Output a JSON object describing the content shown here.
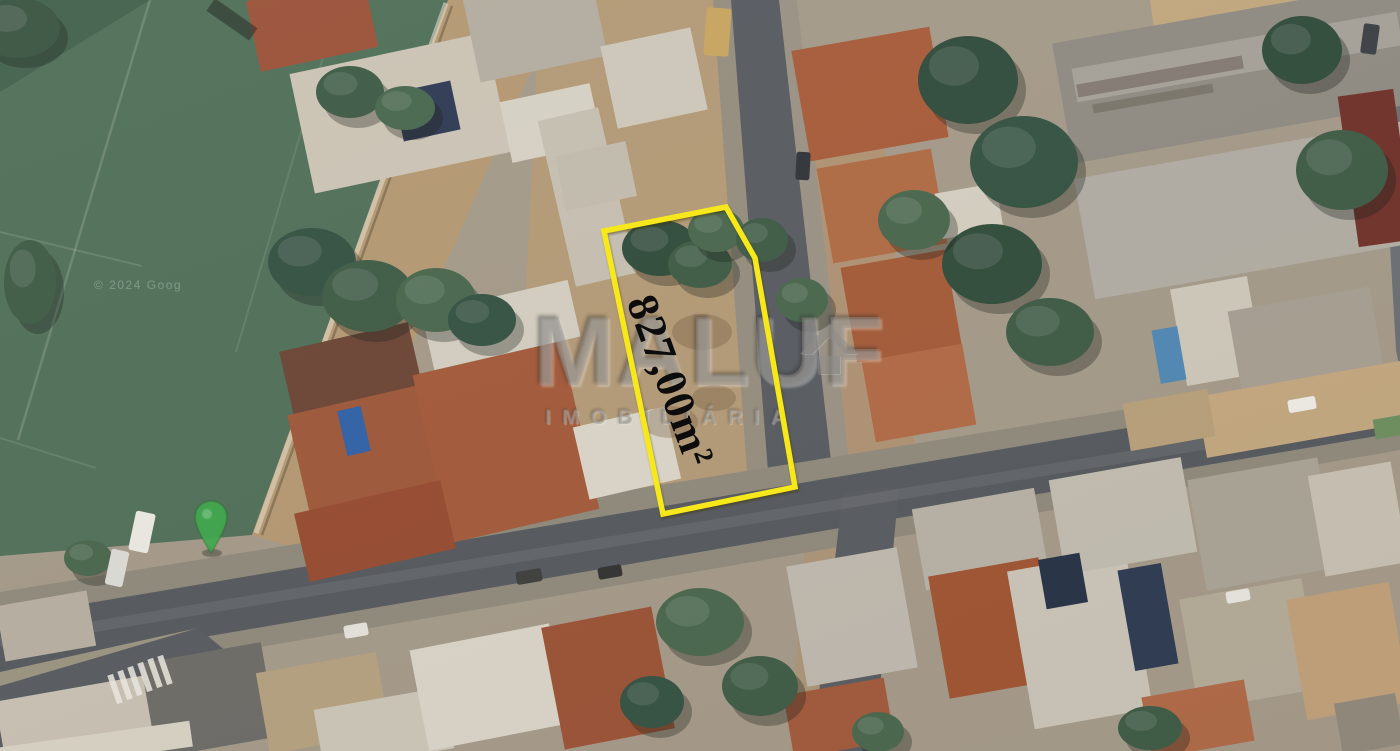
{
  "map": {
    "attribution": "© 2024 Goog",
    "marker_color": "#42a94f"
  },
  "lot": {
    "area_label": "827,00m²",
    "outline_color": "#f7e81b",
    "polygon": "604,231 726,207 755,258 795,487 663,514"
  },
  "watermark": {
    "title": "MALUF",
    "subtitle": "IMOBILIÁRIA"
  },
  "palette": {
    "field_green": "#4e6e57",
    "road_gray": "#53575d",
    "dirt_tan": "#b59872",
    "terracotta": "#a85a38",
    "tree_green": "#315040",
    "outline_yellow": "#f7e81b",
    "pin_green": "#42a94f"
  },
  "scene": {
    "ground": [
      {
        "pts": "0,0 1400,0 1400,751 0,751",
        "f": "#a59a89",
        "name": "ground-base"
      },
      {
        "pts": "0,0 448,0 392,148 252,535 0,556",
        "f": "#4e6e57",
        "name": "soccer-field"
      },
      {
        "pts": "0,0 150,0 0,92",
        "f": "#41604b",
        "name": "field-corner-shade"
      },
      {
        "pts": "448,0 562,0 430,300 330,558 252,535 392,148",
        "f": "#b59872",
        "name": "dirt-strip"
      },
      {
        "pts": "540,0 733,0 770,485 640,520 520,420",
        "f": "#b49a76",
        "name": "dirt-lot-area"
      },
      {
        "pts": "800,150 884,142 918,478 836,480",
        "f": "#b09273",
        "name": "dirt-patch"
      },
      {
        "pts": "1150,0 1382,0 1374,46 1158,56",
        "f": "#c3a87e",
        "name": "dirt-top-right"
      },
      {
        "pts": "806,520 850,516 872,751 790,751",
        "f": "#ac9578",
        "name": "dirt-south-strip"
      }
    ],
    "roads": [
      {
        "pts": "713,0 731,0 769,484 748,486",
        "f": "#958d7e",
        "name": "sidewalk"
      },
      {
        "pts": "779,0 797,0 851,477 833,479",
        "f": "#9a9284",
        "name": "sidewalk"
      },
      {
        "pts": "731,0 779,0 833,479 769,484",
        "f": "#565a60",
        "name": "street-vertical"
      },
      {
        "pts": "0,592 1400,365 1400,382 0,618",
        "f": "#8f897b",
        "name": "sidewalk"
      },
      {
        "pts": "0,672 1400,432 1400,450 0,692",
        "f": "#8f897b",
        "name": "sidewalk"
      },
      {
        "pts": "0,618 1400,382 1400,432 0,672",
        "f": "#53575d",
        "name": "main-road"
      },
      {
        "pts": "843,492 899,487 874,751 812,751",
        "f": "#565a60",
        "name": "street-vertical-south"
      },
      {
        "pts": "0,672 198,628 0,686",
        "f": "#99937f",
        "name": "sidewalk"
      },
      {
        "pts": "0,686 0,748 232,656 198,628",
        "f": "#55595f",
        "name": "street-branch"
      },
      {
        "pts": "1376,0 1400,0 1400,370 1396,350",
        "f": "#6a6e72",
        "name": "street-edge-east"
      }
    ],
    "lines": [
      {
        "d": "M150,0 L18,440",
        "s": "rgba(255,255,255,0.16)",
        "w": 2.5,
        "name": "field-line"
      },
      {
        "d": "M340,0 L236,352",
        "s": "rgba(255,255,255,0.10)",
        "w": 2,
        "name": "field-line"
      },
      {
        "d": "M0,232 L142,266",
        "s": "rgba(255,255,255,0.13)",
        "w": 2,
        "name": "field-line"
      },
      {
        "d": "M0,438 L96,468",
        "s": "rgba(255,255,255,0.11)",
        "w": 2,
        "name": "field-line"
      },
      {
        "d": "M446,3 L256,533",
        "s": "rgba(235,228,210,0.55)",
        "w": 5,
        "name": "field-wall"
      },
      {
        "d": "M452,6 L262,535",
        "s": "rgba(70,60,40,0.40)",
        "w": 2.5,
        "name": "field-wall-shadow"
      },
      {
        "d": "M0,642 L1400,412",
        "s": "rgba(210,210,205,0.10)",
        "w": 11,
        "name": "road-wear"
      }
    ],
    "buildings": [
      [
        252,
        -12,
        120,
        72,
        -12,
        "#9b5138"
      ],
      [
        300,
        52,
        200,
        122,
        -12,
        "#cdc5b6"
      ],
      [
        398,
        86,
        58,
        50,
        -12,
        "#2d3752"
      ],
      [
        470,
        -18,
        130,
        88,
        -12,
        "#b4ada0"
      ],
      [
        505,
        92,
        92,
        62,
        -12,
        "#d8d2c6"
      ],
      [
        556,
        112,
        62,
        170,
        -13,
        "#c7c0b2"
      ],
      [
        286,
        336,
        132,
        76,
        -13,
        "#6b4334"
      ],
      [
        298,
        398,
        142,
        112,
        -13,
        "#9e5637"
      ],
      [
        430,
        356,
        152,
        172,
        -13,
        "#a35838"
      ],
      [
        426,
        296,
        150,
        58,
        -13,
        "#d5cfc2"
      ],
      [
        580,
        416,
        94,
        74,
        -13,
        "#dcd7ca"
      ],
      [
        300,
        496,
        150,
        70,
        -13,
        "#96492e"
      ],
      [
        608,
        36,
        92,
        84,
        -12,
        "#cfc9bc"
      ],
      [
        560,
        148,
        72,
        56,
        -12,
        "#c3bcae"
      ],
      [
        800,
        38,
        140,
        112,
        -10,
        "#a85a38"
      ],
      [
        824,
        158,
        116,
        96,
        -10,
        "#b06a42"
      ],
      [
        848,
        258,
        106,
        96,
        -10,
        "#a55936"
      ],
      [
        868,
        352,
        102,
        82,
        -10,
        "#b26844"
      ],
      [
        938,
        188,
        62,
        46,
        -10,
        "#d6d0c3"
      ],
      [
        1060,
        12,
        352,
        122,
        -10,
        "#8f8a82",
        "warehouse-roof"
      ],
      [
        1072,
        40,
        330,
        34,
        -10,
        "#a6a199",
        "warehouse-roof-band"
      ],
      [
        1082,
        148,
        348,
        122,
        -10,
        "#b2ada4",
        "warehouse-roof"
      ],
      [
        1178,
        282,
        78,
        98,
        -10,
        "#cfc9bc"
      ],
      [
        1348,
        92,
        56,
        152,
        -8,
        "#6f2f28"
      ],
      [
        1238,
        298,
        144,
        132,
        -10,
        "#a79f92"
      ],
      [
        1200,
        378,
        212,
        62,
        -10,
        "#c4a87f"
      ],
      [
        1126,
        396,
        86,
        48,
        -10,
        "#b8a07a"
      ],
      [
        0,
        598,
        92,
        56,
        -10,
        "#b7b0a2"
      ],
      [
        0,
        688,
        152,
        70,
        -10,
        "#c9c2b4"
      ],
      [
        148,
        652,
        122,
        96,
        -10,
        "#6b6a66"
      ],
      [
        262,
        662,
        122,
        82,
        -10,
        "#b4a17f"
      ],
      [
        318,
        698,
        132,
        62,
        -10,
        "#cdc7b9"
      ],
      [
        0,
        734,
        192,
        26,
        -8,
        "#d9d3c5"
      ],
      [
        418,
        636,
        142,
        102,
        -11,
        "#dbd6c9"
      ],
      [
        552,
        616,
        112,
        124,
        -11,
        "#9b5134"
      ],
      [
        796,
        556,
        112,
        122,
        -10,
        "#c0bab0"
      ],
      [
        788,
        686,
        102,
        64,
        -10,
        "#a2583a"
      ],
      [
        918,
        498,
        124,
        82,
        -10,
        "#b9b3a7"
      ],
      [
        938,
        566,
        112,
        124,
        -10,
        "#a0522f"
      ],
      [
        1020,
        560,
        120,
        160,
        -10,
        "#ccc6ba"
      ],
      [
        1056,
        468,
        134,
        96,
        -10,
        "#c3beb2"
      ],
      [
        1196,
        468,
        132,
        112,
        -10,
        "#aaa496"
      ],
      [
        1188,
        588,
        124,
        112,
        -10,
        "#b5ab99"
      ],
      [
        1316,
        468,
        84,
        102,
        -10,
        "#c9c2b4"
      ],
      [
        1296,
        590,
        104,
        122,
        -10,
        "#c2a179"
      ],
      [
        1146,
        688,
        104,
        62,
        -10,
        "#b06845"
      ],
      [
        1338,
        698,
        62,
        52,
        -10,
        "#90897c"
      ]
    ],
    "extras": [
      {
        "t": "rect",
        "x": 342,
        "y": 408,
        "w": 24,
        "h": 46,
        "r": -13,
        "f": "#2d5fa8",
        "name": "swimming-pool"
      },
      {
        "t": "rect",
        "x": 1156,
        "y": 328,
        "w": 26,
        "h": 54,
        "r": -10,
        "f": "#4d87b5",
        "name": "swimming-pool"
      },
      {
        "t": "rect",
        "x": 1042,
        "y": 556,
        "w": 42,
        "h": 50,
        "r": -10,
        "f": "#233044",
        "name": "solar-panels"
      },
      {
        "t": "rect",
        "x": 1126,
        "y": 566,
        "w": 44,
        "h": 102,
        "r": -10,
        "f": "#2a3850",
        "name": "solar-panels"
      },
      {
        "t": "rect",
        "x": 1374,
        "y": 416,
        "w": 42,
        "h": 20,
        "r": -10,
        "f": "#6d8f5e",
        "name": "lawn-strip"
      },
      {
        "t": "rect",
        "x": 206,
        "y": 12,
        "w": 52,
        "h": 15,
        "r": 35,
        "f": "rgba(25,30,25,0.5)",
        "name": "goal-shadow"
      },
      {
        "t": "rect",
        "x": 1076,
        "y": 70,
        "w": 168,
        "h": 13,
        "r": -10,
        "f": "rgba(70,60,52,0.38)",
        "name": "roof-text-smudge"
      },
      {
        "t": "rect",
        "x": 1092,
        "y": 94,
        "w": 122,
        "h": 9,
        "r": -10,
        "f": "rgba(70,60,52,0.28)",
        "name": "roof-text-smudge"
      },
      {
        "t": "ell",
        "x": 652,
        "y": 254,
        "w": 26,
        "h": 16,
        "f": "rgba(105,78,52,0.38)",
        "name": "dirt-blotch"
      },
      {
        "t": "ell",
        "x": 702,
        "y": 332,
        "w": 30,
        "h": 18,
        "f": "rgba(110,82,55,0.33)",
        "name": "dirt-blotch"
      },
      {
        "t": "ell",
        "x": 670,
        "y": 422,
        "w": 28,
        "h": 16,
        "f": "rgba(115,85,58,0.33)",
        "name": "dirt-blotch"
      },
      {
        "t": "ell",
        "x": 714,
        "y": 398,
        "w": 22,
        "h": 13,
        "f": "rgba(100,75,50,0.30)",
        "name": "dirt-blotch"
      },
      {
        "t": "rect",
        "x": 112,
        "y": 674,
        "w": 6,
        "h": 30,
        "r": -19,
        "f": "rgba(238,235,228,0.85)",
        "name": "crosswalk-stripe"
      },
      {
        "t": "rect",
        "x": 122,
        "y": 670,
        "w": 6,
        "h": 30,
        "r": -19,
        "f": "rgba(238,235,228,0.85)",
        "name": "crosswalk-stripe"
      },
      {
        "t": "rect",
        "x": 132,
        "y": 666,
        "w": 6,
        "h": 30,
        "r": -19,
        "f": "rgba(238,235,228,0.85)",
        "name": "crosswalk-stripe"
      },
      {
        "t": "rect",
        "x": 142,
        "y": 662,
        "w": 6,
        "h": 30,
        "r": -19,
        "f": "rgba(238,235,228,0.85)",
        "name": "crosswalk-stripe"
      },
      {
        "t": "rect",
        "x": 152,
        "y": 658,
        "w": 6,
        "h": 30,
        "r": -19,
        "f": "rgba(238,235,228,0.85)",
        "name": "crosswalk-stripe"
      },
      {
        "t": "rect",
        "x": 162,
        "y": 655,
        "w": 6,
        "h": 30,
        "r": -19,
        "f": "rgba(238,235,228,0.85)",
        "name": "crosswalk-stripe"
      }
    ],
    "trees": [
      [
        18,
        28,
        42,
        30,
        "#39523f"
      ],
      [
        30,
        282,
        26,
        42,
        "#3c5a44"
      ],
      [
        312,
        262,
        44,
        34,
        "#315040"
      ],
      [
        368,
        296,
        46,
        36,
        "#3c5a44"
      ],
      [
        436,
        300,
        40,
        32,
        "#47664c"
      ],
      [
        482,
        320,
        34,
        26,
        "#315040"
      ],
      [
        350,
        92,
        34,
        26,
        "#3c5a44"
      ],
      [
        405,
        108,
        30,
        22,
        "#47664c"
      ],
      [
        660,
        248,
        38,
        28,
        "#2e4a3a"
      ],
      [
        700,
        264,
        32,
        24,
        "#3c5a44"
      ],
      [
        716,
        230,
        28,
        22,
        "#47664c"
      ],
      [
        762,
        240,
        26,
        22,
        "#3c5a44"
      ],
      [
        802,
        300,
        26,
        22,
        "#47664c"
      ],
      [
        968,
        80,
        50,
        44,
        "#2e4a3a"
      ],
      [
        1024,
        162,
        54,
        46,
        "#315040"
      ],
      [
        992,
        264,
        50,
        40,
        "#2e4a3a"
      ],
      [
        1050,
        332,
        44,
        34,
        "#3c5a44"
      ],
      [
        914,
        220,
        36,
        30,
        "#47664c"
      ],
      [
        1342,
        170,
        46,
        40,
        "#3c5a44"
      ],
      [
        1302,
        50,
        40,
        34,
        "#2e4a3a"
      ],
      [
        700,
        622,
        44,
        34,
        "#47664c"
      ],
      [
        760,
        686,
        38,
        30,
        "#3c5a44"
      ],
      [
        652,
        702,
        32,
        26,
        "#315040"
      ],
      [
        88,
        558,
        24,
        18,
        "#47664c"
      ],
      [
        1150,
        728,
        32,
        22,
        "#3c5a44"
      ],
      [
        878,
        732,
        26,
        20,
        "#47664c"
      ]
    ],
    "vehicles": [
      [
        132,
        512,
        20,
        40,
        12,
        "#eceae4"
      ],
      [
        108,
        550,
        18,
        36,
        12,
        "#dedcd6"
      ],
      [
        705,
        8,
        25,
        48,
        4,
        "#c9a55f"
      ],
      [
        796,
        152,
        14,
        28,
        3,
        "#2e3238"
      ],
      [
        516,
        570,
        26,
        13,
        -10,
        "#3c3c3c"
      ],
      [
        598,
        566,
        24,
        12,
        -10,
        "#2f2f2f"
      ],
      [
        1288,
        398,
        28,
        13,
        -10,
        "#f0eee8"
      ],
      [
        1226,
        590,
        24,
        12,
        -10,
        "#eae8e2"
      ],
      [
        344,
        624,
        24,
        13,
        -10,
        "#e6e4de"
      ],
      [
        1362,
        24,
        16,
        30,
        8,
        "#3a3e44"
      ]
    ]
  }
}
